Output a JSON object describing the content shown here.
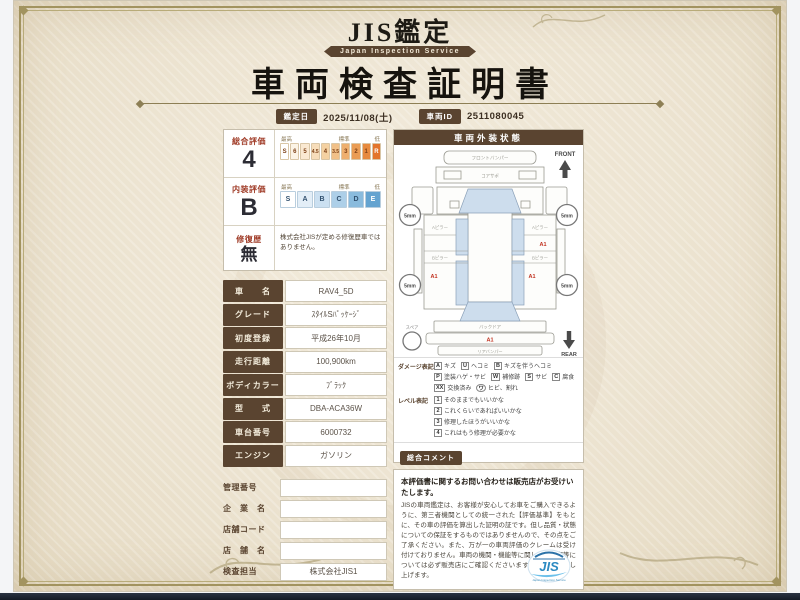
{
  "colors": {
    "brand_brown": "#5a4430",
    "accent_red": "#a03c28",
    "damage_red": "#c23321",
    "scale_orange": "#e3752c",
    "scale_blue": "#64a3d0",
    "logo_blue": "#2b8ac2",
    "paper": "#ece3d0"
  },
  "header": {
    "brand": "JIS鑑定",
    "brand_sub": "Japan Inspection Service",
    "title": "車両検査証明書",
    "date_label": "鑑定日",
    "date_value": "2025/11/08(土)",
    "id_label": "車両ID",
    "id_value": "2511080045"
  },
  "evaluation": {
    "overall": {
      "label": "総合評価",
      "grade": "4",
      "scale": [
        "S",
        "6",
        "5",
        "4.5",
        "4",
        "3.5",
        "3",
        "2",
        "1",
        "R"
      ],
      "heads": [
        "最高",
        "標準",
        "低"
      ]
    },
    "interior": {
      "label": "内装評価",
      "grade": "B",
      "scale": [
        "S",
        "A",
        "B",
        "C",
        "D",
        "E"
      ],
      "heads": [
        "最高",
        "標準",
        "低"
      ]
    },
    "repair": {
      "label": "修復歴",
      "grade": "無",
      "note": "株式会社JISが定める修復歴車ではありません。"
    }
  },
  "spec_rows": [
    {
      "label": "車　　名",
      "value": "RAV4_5D"
    },
    {
      "label": "グレード",
      "value": "ｽﾀｲﾙSﾊﾟｯｹｰｼﾞ"
    },
    {
      "label": "初度登録",
      "value": "平成26年10月"
    },
    {
      "label": "走行距離",
      "value": "100,900km"
    },
    {
      "label": "ボディカラー",
      "value": "ﾌﾞﾗｯｸ"
    },
    {
      "label": "型　　式",
      "value": "DBA-ACA36W"
    },
    {
      "label": "車台番号",
      "value": "6000732"
    },
    {
      "label": "エンジン",
      "value": "ガソリン"
    }
  ],
  "dealer_rows": [
    {
      "label": "管理番号",
      "value": ""
    },
    {
      "label": "企　業　名",
      "value": ""
    },
    {
      "label": "店舗コード",
      "value": ""
    },
    {
      "label": "店　舗　名",
      "value": ""
    },
    {
      "label": "検査担当",
      "value": "株式会社JIS1"
    }
  ],
  "exterior": {
    "title": "車両外装状態",
    "front_label": "FRONT",
    "rear_label": "REAR",
    "spare_label": "スペア",
    "treads": [
      "5mm",
      "5mm",
      "5mm",
      "5mm"
    ],
    "parts": {
      "front_bumper": "フロントバンパー",
      "core_support": "コアサポ",
      "a_pillar": "Aピラー",
      "b_pillar": "Bピラー",
      "back_door": "バックドア",
      "rear_bumper": "リアバンパー"
    },
    "marks": [
      "A1",
      "A1",
      "A1",
      "A1"
    ]
  },
  "damage_legend": {
    "label": "ダメージ表記",
    "items": [
      {
        "code": "A",
        "text": "キズ"
      },
      {
        "code": "U",
        "text": "ヘコミ"
      },
      {
        "code": "B",
        "text": "キズを伴うヘコミ"
      },
      {
        "code": "P",
        "text": "塗装ハゲ・サビ"
      },
      {
        "code": "W",
        "text": "補修跡"
      },
      {
        "code": "S",
        "text": "サビ"
      },
      {
        "code": "C",
        "text": "腐食"
      },
      {
        "code": "XX",
        "text": "交換済み"
      },
      {
        "code": "ワ",
        "text": "ヒビ、割れ"
      }
    ]
  },
  "level_legend": {
    "label": "レベル表記",
    "items": [
      {
        "code": "1",
        "text": "そのままでもいいかな"
      },
      {
        "code": "2",
        "text": "これくらいであればいいかな"
      },
      {
        "code": "3",
        "text": "修理したほうがいいかな"
      },
      {
        "code": "4",
        "text": "これはもう修理が必要かな"
      }
    ]
  },
  "comment": {
    "label": "総合コメント",
    "line1": "ハンドル、Sノブスレ",
    "line2": "リム、U"
  },
  "disclaimer": {
    "title": "本評価書に関するお問い合わせは販売店がお受けいたします。",
    "body": "JISの車両鑑定は、お客様が安心してお車をご購入できるように、第三者機関としての統一された【評価基準】をもとに、その車の評価を算出した証明の証です。但し品質・状態についての保証をするものではありませんので、その点をご了承ください。また、万が一の車両評価のクレームは受け付けておりません。車両の機関・機能等に関しての内容等については必ず販売店にご確認くださいますようお願い申し上げます。"
  },
  "logo": {
    "text": "JIS",
    "sub": "Japan Inspection Service"
  }
}
